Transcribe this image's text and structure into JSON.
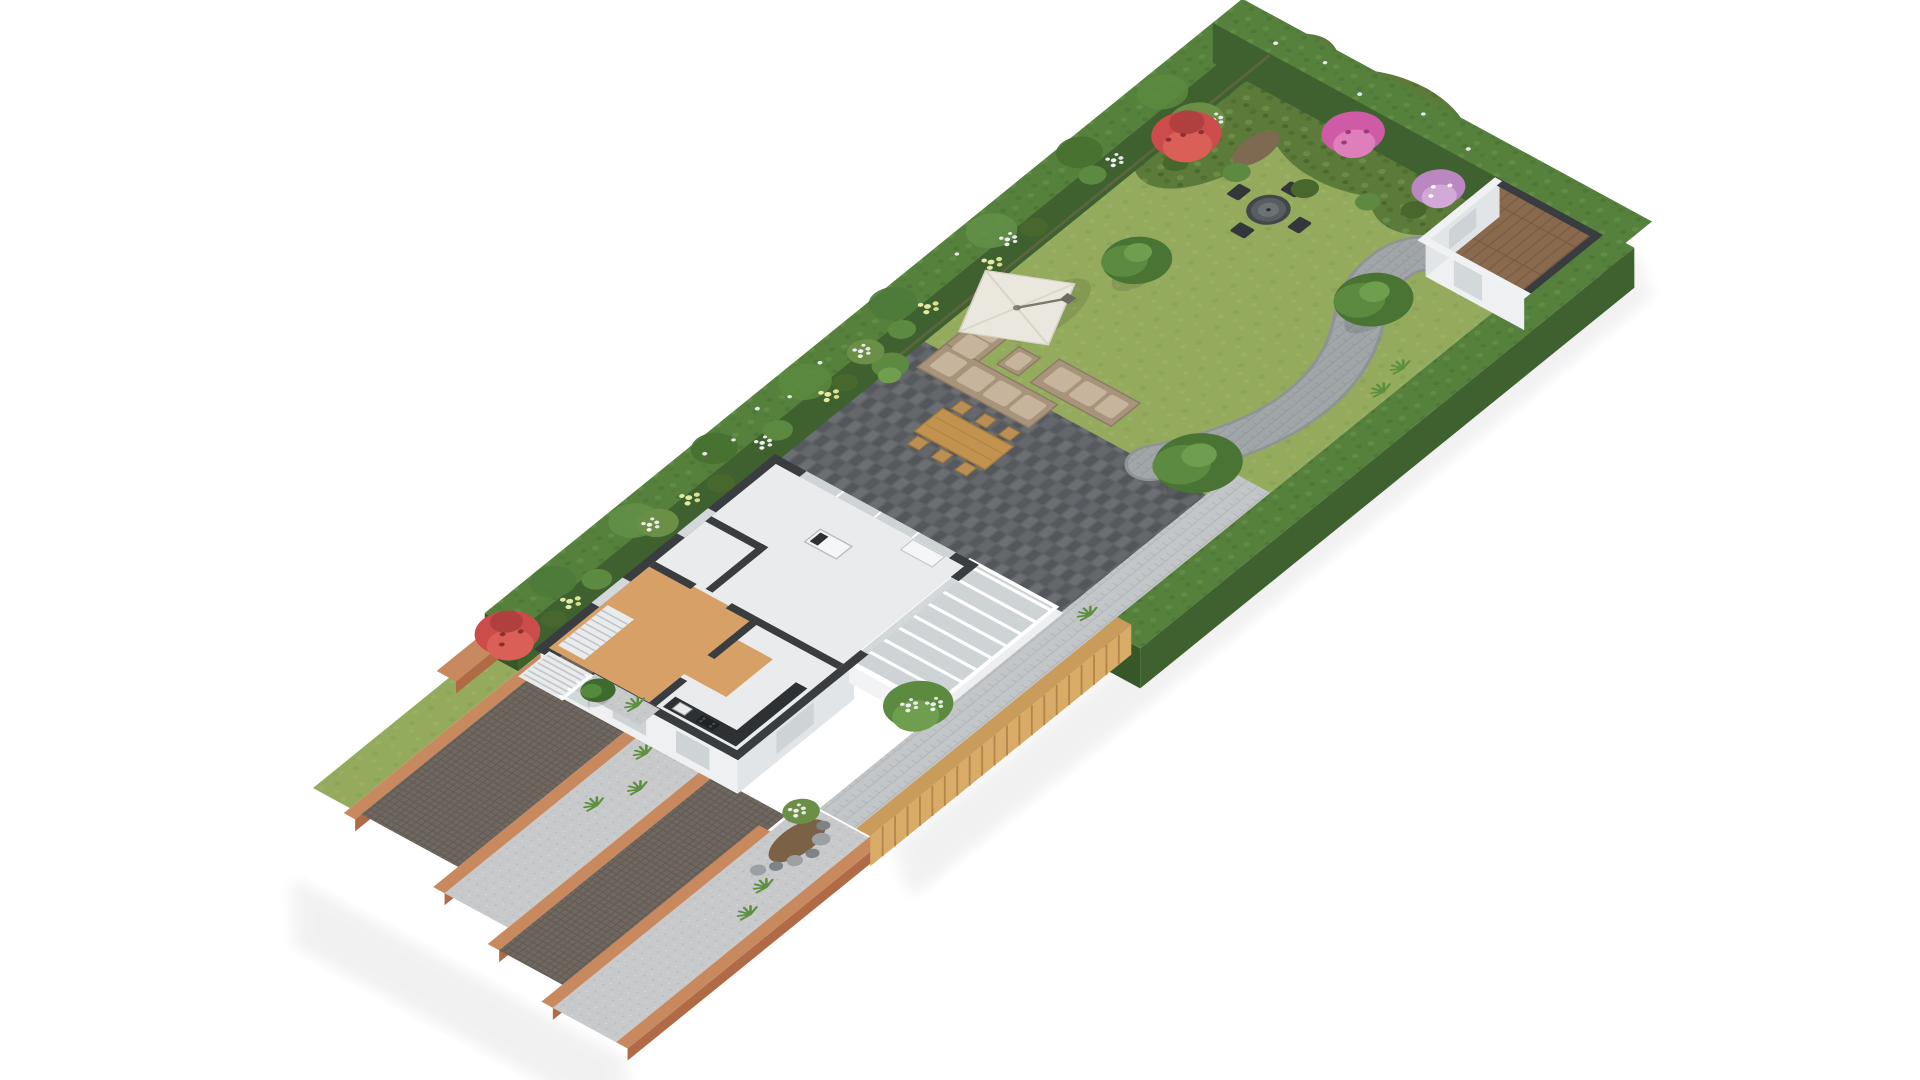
{
  "page": {
    "title": "3D garden floor plan (axonometric render)",
    "background": "#ffffff"
  },
  "colors": {
    "background": "#ffffff",
    "lawn": "#94ab5d",
    "hedgeTop": "#55813c",
    "hedgeSide": "#3e612f",
    "hedgeDark": "#365829",
    "bedGreen": "#5c7a3a",
    "soil": "#7d6a50",
    "rockSoil": "#7b6247",
    "flowerRed": "#cc4b4b",
    "flowerRedLight": "#d95f57",
    "flowerRedDark": "#b03f3f",
    "flowerPink": "#cf5ba6",
    "flowerPinkLight": "#de7fbc",
    "flowerPurple": "#bb87c0",
    "flowerPurpleLight": "#d2a8d6",
    "flowerWhite": "#efefef",
    "flowerYellow": "#e6e9a5",
    "treeDark": "#4a7434",
    "treeMid": "#5c8a40",
    "treeLight": "#6f9e4e",
    "pathGray": "#a1a6a9",
    "pathEdge": "#8e9396",
    "paverLight": "#c3c6c8",
    "patio": "#5f6366",
    "driveway": "#6f6860",
    "frontLight": "#c7c9cb",
    "terracotta": "#c9895f",
    "terracottaSide": "#b06a45",
    "fenceTop": "#c99c5b",
    "fenceSide": "#d8ac66",
    "fenceLine": "#b5854a",
    "wallTop": "#3a3d40",
    "houseFace": "#eef0f2",
    "houseFaceShade": "#e2e5e7",
    "houseFloor": "#e9ebed",
    "hallFloor": "#d7a066",
    "counter": "#2e3133",
    "glass": "#ced3d6",
    "glassLight": "#d3d8db",
    "shedFloor": "#8a6a4e",
    "sofa": "#a8937b",
    "cushion": "#c6b49c",
    "umbrella": "#eae7de",
    "woodTable": "#c1934f",
    "rock": "#9aa0a4",
    "rockDark": "#7d8387",
    "stairTread": "#e9ebec",
    "white": "#ffffff"
  },
  "objects": [
    "boundary hedge",
    "back garden lawn",
    "curved paver path",
    "garden shed with wood floor",
    "flower beds with red, pink, purple, white and yellow blooms",
    "round dining set",
    "lounge set with parasol",
    "wooden dining table on slate patio",
    "timber fence",
    "cutaway house floor plan with hall, kitchen, living room and conservatory",
    "exterior entrance stairs",
    "terraced front garden with paved driveways",
    "terracotta retaining walls",
    "trees, shrubs and rock bed"
  ]
}
